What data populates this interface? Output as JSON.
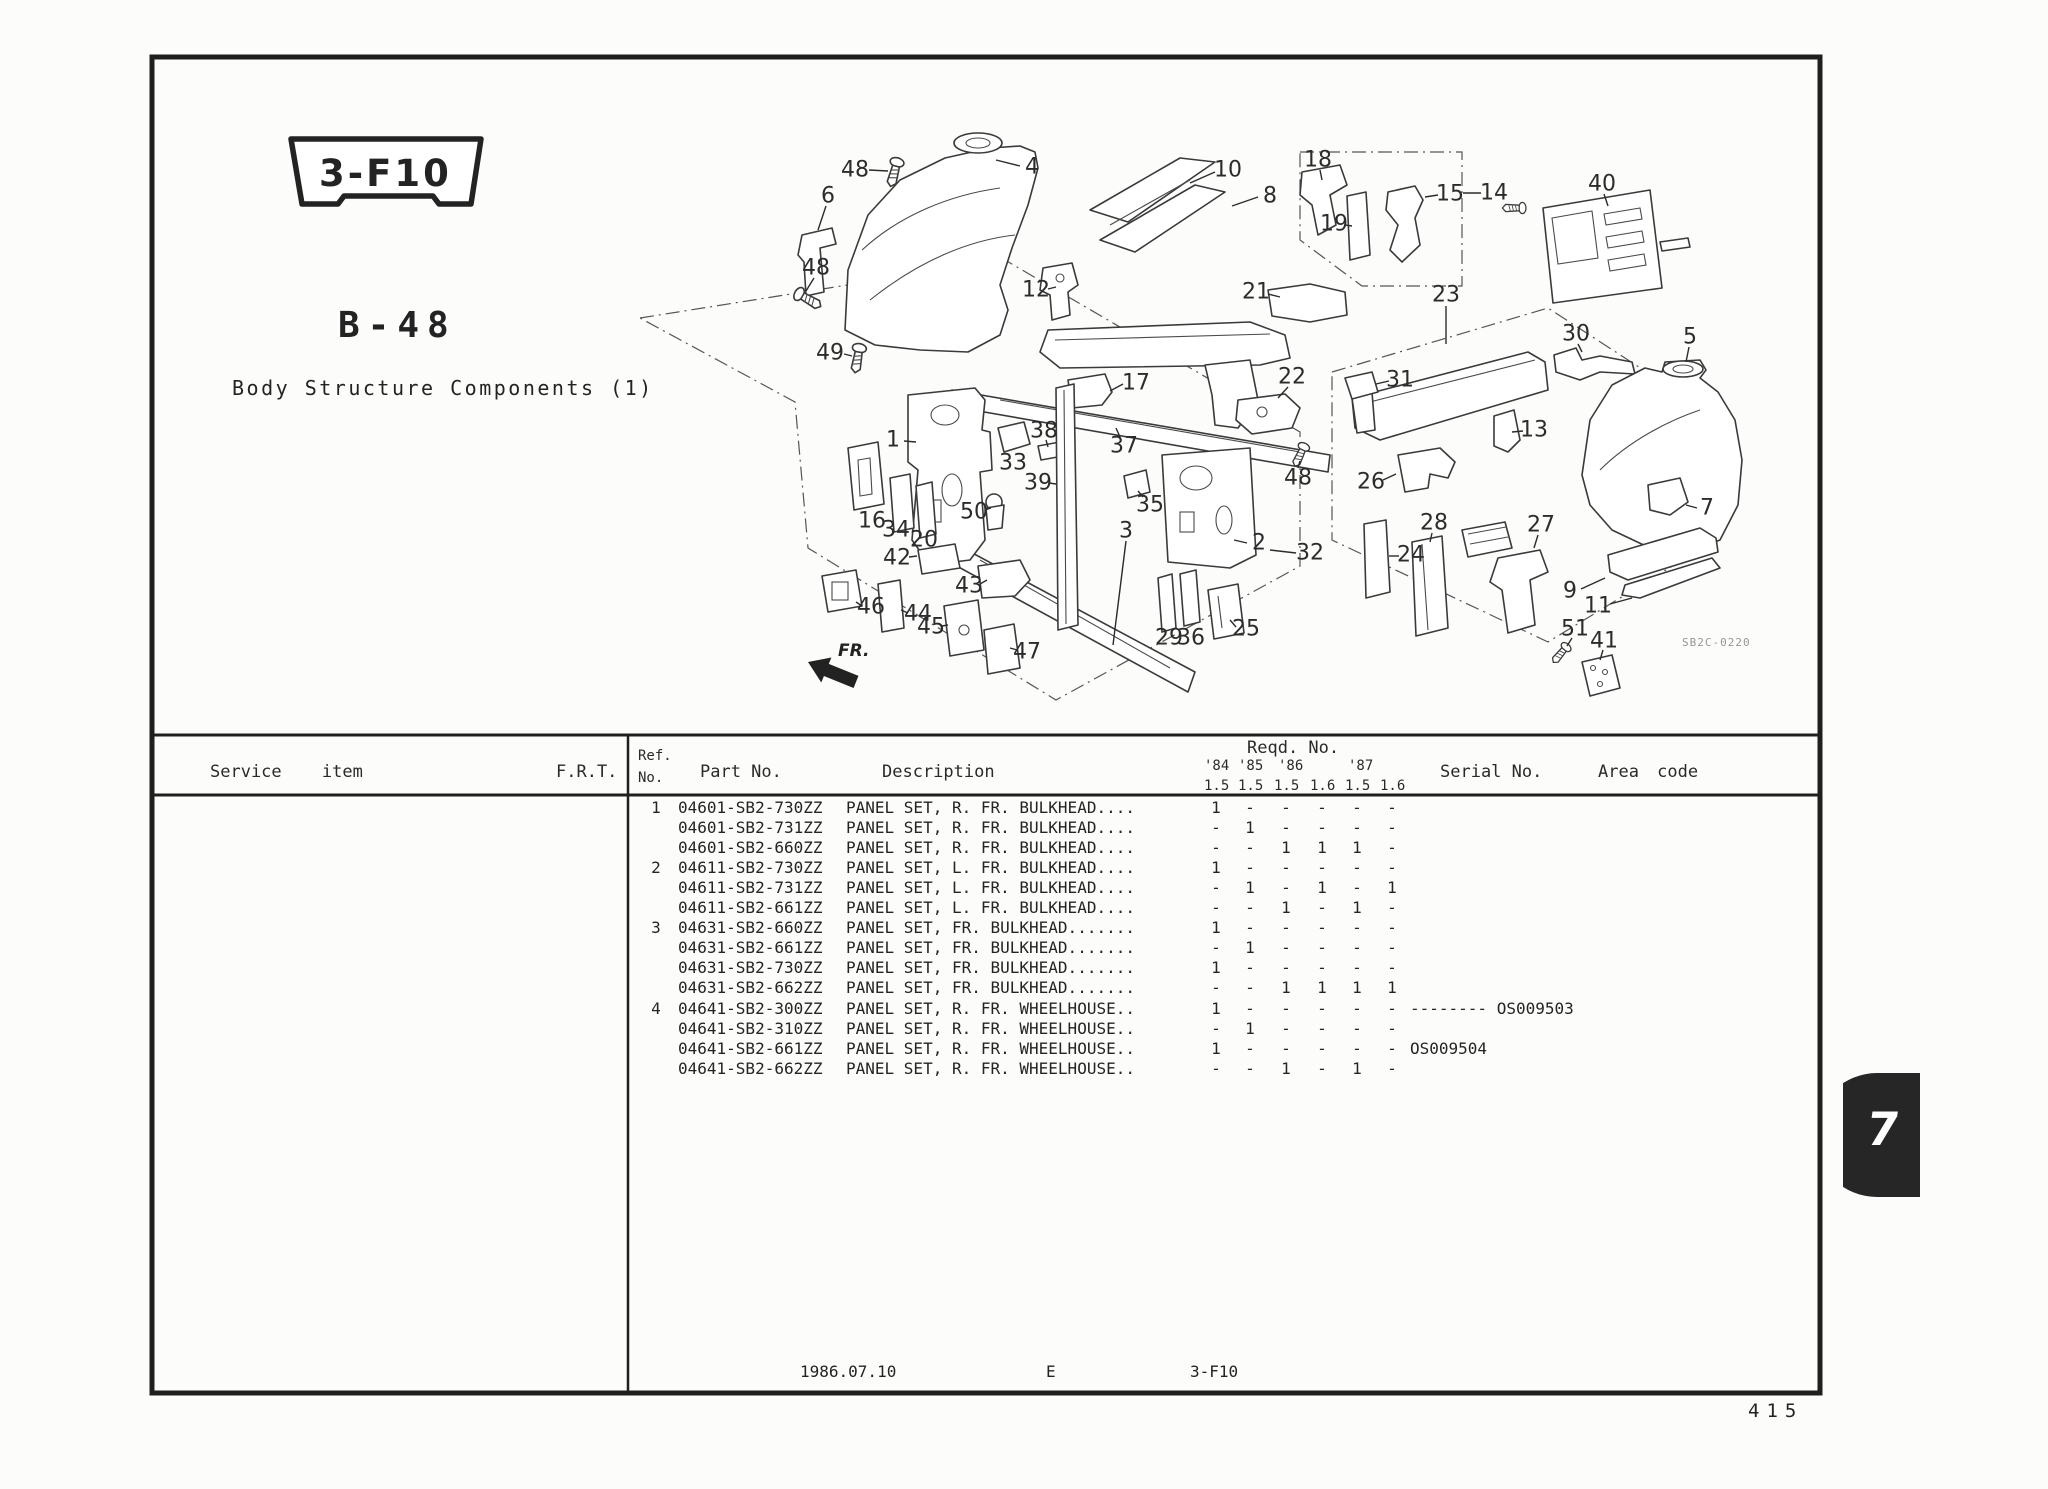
{
  "colors": {
    "ink": "#232323",
    "line": "#2b2b2b",
    "tab_bg": "#262626",
    "muted": "#979790"
  },
  "page": {
    "badge": "3-F10",
    "section_code": "B-48",
    "title": "Body Structure Components (1)",
    "diagram_code": "SB2C-0220",
    "fr_label": "FR.",
    "footer": {
      "date": "1986.07.10",
      "edition": "E",
      "code": "3-F10"
    },
    "page_number": "415",
    "tab_number": "7"
  },
  "table": {
    "headers": {
      "service_item": "Service item",
      "frt": "F.R.T.",
      "ref_line1": "Ref.",
      "ref_line2": "No.",
      "part_no": "Part No.",
      "description": "Description",
      "reqd_no": "Reqd. No.",
      "serial_no": "Serial No.",
      "area_code": "Area code"
    },
    "year_labels": [
      "'84",
      "'85",
      "'86",
      "'87"
    ],
    "model_values": [
      "1.5",
      "1.5",
      "1.5",
      "1.6",
      "1.5",
      "1.6"
    ],
    "rows": [
      {
        "ref": "1",
        "part_no": "04601-SB2-730ZZ",
        "description": "PANEL SET, R. FR. BULKHEAD....",
        "qty": [
          "1",
          "-",
          "-",
          "-",
          "-",
          "-"
        ],
        "serial": ""
      },
      {
        "ref": "",
        "part_no": "04601-SB2-731ZZ",
        "description": "PANEL SET, R. FR. BULKHEAD....",
        "qty": [
          "-",
          "1",
          "-",
          "-",
          "-",
          "-"
        ],
        "serial": ""
      },
      {
        "ref": "",
        "part_no": "04601-SB2-660ZZ",
        "description": "PANEL SET, R. FR. BULKHEAD....",
        "qty": [
          "-",
          "-",
          "1",
          "1",
          "1",
          "-"
        ],
        "serial": ""
      },
      {
        "ref": "2",
        "part_no": "04611-SB2-730ZZ",
        "description": "PANEL SET, L. FR. BULKHEAD....",
        "qty": [
          "1",
          "-",
          "-",
          "-",
          "-",
          "-"
        ],
        "serial": ""
      },
      {
        "ref": "",
        "part_no": "04611-SB2-731ZZ",
        "description": "PANEL SET, L. FR. BULKHEAD....",
        "qty": [
          "-",
          "1",
          "-",
          "1",
          "-",
          "1"
        ],
        "serial": ""
      },
      {
        "ref": "",
        "part_no": "04611-SB2-661ZZ",
        "description": "PANEL SET, L. FR. BULKHEAD....",
        "qty": [
          "-",
          "-",
          "1",
          "-",
          "1",
          "-"
        ],
        "serial": ""
      },
      {
        "ref": "3",
        "part_no": "04631-SB2-660ZZ",
        "description": "PANEL SET, FR. BULKHEAD.......",
        "qty": [
          "1",
          "-",
          "-",
          "-",
          "-",
          "-"
        ],
        "serial": ""
      },
      {
        "ref": "",
        "part_no": "04631-SB2-661ZZ",
        "description": "PANEL SET, FR. BULKHEAD.......",
        "qty": [
          "-",
          "1",
          "-",
          "-",
          "-",
          "-"
        ],
        "serial": ""
      },
      {
        "ref": "",
        "part_no": "04631-SB2-730ZZ",
        "description": "PANEL SET, FR. BULKHEAD.......",
        "qty": [
          "1",
          "-",
          "-",
          "-",
          "-",
          "-"
        ],
        "serial": ""
      },
      {
        "ref": "",
        "part_no": "04631-SB2-662ZZ",
        "description": "PANEL SET, FR. BULKHEAD.......",
        "qty": [
          "-",
          "-",
          "1",
          "1",
          "1",
          "1"
        ],
        "serial": ""
      },
      {
        "ref": "4",
        "part_no": "04641-SB2-300ZZ",
        "description": "PANEL SET, R. FR. WHEELHOUSE..",
        "qty": [
          "1",
          "-",
          "-",
          "-",
          "-",
          "-"
        ],
        "serial": "-------- OS009503"
      },
      {
        "ref": "",
        "part_no": "04641-SB2-310ZZ",
        "description": "PANEL SET, R. FR. WHEELHOUSE..",
        "qty": [
          "-",
          "1",
          "-",
          "-",
          "-",
          "-"
        ],
        "serial": ""
      },
      {
        "ref": "",
        "part_no": "04641-SB2-661ZZ",
        "description": "PANEL SET, R. FR. WHEELHOUSE..",
        "qty": [
          "1",
          "-",
          "-",
          "-",
          "-",
          "-"
        ],
        "serial": "OS009504"
      },
      {
        "ref": "",
        "part_no": "04641-SB2-662ZZ",
        "description": "PANEL SET, R. FR. WHEELHOUSE..",
        "qty": [
          "-",
          "-",
          "1",
          "-",
          "1",
          "-"
        ],
        "serial": ""
      }
    ]
  },
  "diagram": {
    "labels": [
      {
        "t": "48",
        "x": 855,
        "y": 170,
        "l": [
          869,
          170,
          888,
          171
        ]
      },
      {
        "t": "4",
        "x": 1032,
        "y": 167,
        "l": [
          1020,
          166,
          996,
          160
        ]
      },
      {
        "t": "6",
        "x": 828,
        "y": 196,
        "l": [
          826,
          206,
          818,
          230
        ]
      },
      {
        "t": "48",
        "x": 816,
        "y": 268,
        "l": [
          814,
          278,
          806,
          291
        ]
      },
      {
        "t": "49",
        "x": 830,
        "y": 353,
        "l": [
          844,
          354,
          852,
          356
        ]
      },
      {
        "t": "10",
        "x": 1228,
        "y": 170,
        "l": [
          1215,
          172,
          1190,
          183
        ]
      },
      {
        "t": "8",
        "x": 1270,
        "y": 196,
        "l": [
          1258,
          197,
          1232,
          206
        ]
      },
      {
        "t": "12",
        "x": 1036,
        "y": 290,
        "l": [
          1048,
          289,
          1056,
          287
        ]
      },
      {
        "t": "21",
        "x": 1256,
        "y": 292,
        "l": [
          1268,
          294,
          1280,
          297
        ]
      },
      {
        "t": "17",
        "x": 1136,
        "y": 383,
        "l": [
          1123,
          384,
          1110,
          391
        ]
      },
      {
        "t": "22",
        "x": 1292,
        "y": 377,
        "l": [
          1288,
          387,
          1278,
          398
        ]
      },
      {
        "t": "48",
        "x": 1298,
        "y": 478,
        "l": [
          1298,
          468,
          1300,
          461
        ]
      },
      {
        "t": "18",
        "x": 1318,
        "y": 160,
        "l": [
          1320,
          170,
          1322,
          180
        ]
      },
      {
        "t": "19",
        "x": 1334,
        "y": 224,
        "l": [
          1345,
          225,
          1352,
          226
        ]
      },
      {
        "t": "15",
        "x": 1450,
        "y": 194,
        "l": [
          1438,
          195,
          1425,
          197
        ]
      },
      {
        "t": "14",
        "x": 1494,
        "y": 193,
        "l": [
          1463,
          193,
          1481,
          193
        ]
      },
      {
        "t": "40",
        "x": 1602,
        "y": 184,
        "l": [
          1604,
          194,
          1608,
          206
        ]
      },
      {
        "t": "23",
        "x": 1446,
        "y": 295,
        "l": [
          1446,
          306,
          1446,
          344
        ]
      },
      {
        "t": "30",
        "x": 1576,
        "y": 334,
        "l": [
          1578,
          344,
          1582,
          352
        ]
      },
      {
        "t": "5",
        "x": 1690,
        "y": 337,
        "l": [
          1689,
          347,
          1686,
          362
        ]
      },
      {
        "t": "31",
        "x": 1400,
        "y": 380,
        "l": [
          1389,
          381,
          1376,
          384
        ]
      },
      {
        "t": "13",
        "x": 1534,
        "y": 430,
        "l": [
          1523,
          431,
          1512,
          432
        ]
      },
      {
        "t": "26",
        "x": 1371,
        "y": 482,
        "l": [
          1383,
          480,
          1396,
          474
        ]
      },
      {
        "t": "7",
        "x": 1707,
        "y": 508,
        "l": [
          1697,
          508,
          1686,
          505
        ]
      },
      {
        "t": "1",
        "x": 893,
        "y": 440,
        "l": [
          904,
          441,
          916,
          442
        ]
      },
      {
        "t": "33",
        "x": 1013,
        "y": 463
      },
      {
        "t": "38",
        "x": 1044,
        "y": 431,
        "l": [
          1046,
          440,
          1048,
          447
        ]
      },
      {
        "t": "37",
        "x": 1124,
        "y": 446,
        "l": [
          1120,
          437,
          1116,
          428
        ]
      },
      {
        "t": "39",
        "x": 1038,
        "y": 483,
        "l": [
          1049,
          483,
          1056,
          484
        ]
      },
      {
        "t": "35",
        "x": 1150,
        "y": 505,
        "l": [
          1143,
          497,
          1138,
          491
        ]
      },
      {
        "t": "16",
        "x": 872,
        "y": 521
      },
      {
        "t": "34",
        "x": 896,
        "y": 530
      },
      {
        "t": "20",
        "x": 924,
        "y": 540
      },
      {
        "t": "50",
        "x": 974,
        "y": 512,
        "l": [
          985,
          510,
          991,
          508
        ]
      },
      {
        "t": "3",
        "x": 1126,
        "y": 531,
        "l": [
          1126,
          541,
          1113,
          645
        ]
      },
      {
        "t": "2",
        "x": 1259,
        "y": 543,
        "l": [
          1247,
          543,
          1234,
          540
        ]
      },
      {
        "t": "32",
        "x": 1310,
        "y": 553,
        "l": [
          1296,
          553,
          1270,
          550
        ]
      },
      {
        "t": "24",
        "x": 1411,
        "y": 555,
        "l": [
          1399,
          556,
          1389,
          556
        ]
      },
      {
        "t": "28",
        "x": 1434,
        "y": 523,
        "l": [
          1432,
          533,
          1430,
          542
        ]
      },
      {
        "t": "27",
        "x": 1541,
        "y": 525,
        "l": [
          1538,
          535,
          1534,
          548
        ]
      },
      {
        "t": "9",
        "x": 1570,
        "y": 591,
        "l": [
          1581,
          589,
          1605,
          578
        ]
      },
      {
        "t": "11",
        "x": 1598,
        "y": 606,
        "l": [
          1610,
          604,
          1632,
          598
        ]
      },
      {
        "t": "29",
        "x": 1169,
        "y": 638
      },
      {
        "t": "36",
        "x": 1191,
        "y": 638
      },
      {
        "t": "25",
        "x": 1246,
        "y": 629,
        "l": [
          1236,
          627,
          1230,
          620
        ]
      },
      {
        "t": "42",
        "x": 897,
        "y": 558,
        "l": [
          909,
          557,
          917,
          556
        ]
      },
      {
        "t": "43",
        "x": 969,
        "y": 586,
        "l": [
          980,
          584,
          987,
          580
        ]
      },
      {
        "t": "46",
        "x": 871,
        "y": 607,
        "l": [
          862,
          606,
          856,
          602
        ]
      },
      {
        "t": "44",
        "x": 918,
        "y": 614,
        "l": [
          908,
          613,
          901,
          610
        ]
      },
      {
        "t": "45",
        "x": 931,
        "y": 627,
        "l": [
          942,
          626,
          948,
          625
        ]
      },
      {
        "t": "47",
        "x": 1027,
        "y": 652,
        "l": [
          1017,
          650,
          1010,
          648
        ]
      },
      {
        "t": "51",
        "x": 1575,
        "y": 629,
        "l": [
          1572,
          638,
          1567,
          646
        ]
      },
      {
        "t": "41",
        "x": 1604,
        "y": 641,
        "l": [
          1603,
          650,
          1600,
          660
        ]
      }
    ]
  }
}
